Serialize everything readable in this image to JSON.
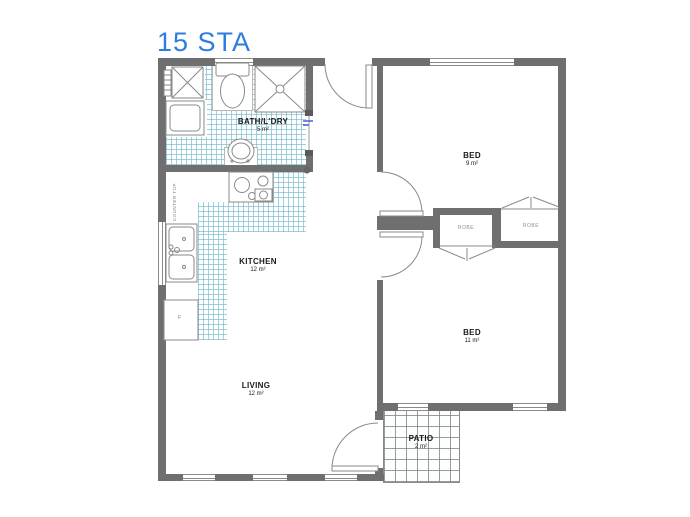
{
  "title": "15 STA",
  "rooms": [
    {
      "name": "BATH/L'DRY",
      "area": "5 m²"
    },
    {
      "name": "KITCHEN",
      "area": "12 m²"
    },
    {
      "name": "LIVING",
      "area": "12 m²"
    },
    {
      "name": "BED",
      "area": "9 m²"
    },
    {
      "name": "BED",
      "area": "11 m²"
    },
    {
      "name": "PATIO",
      "area": "2 m²"
    }
  ],
  "closets": [
    {
      "name": "ROBE"
    },
    {
      "name": "ROBE"
    }
  ],
  "annotations": {
    "counter_top": "COUNTER TOP",
    "fridge": "F"
  },
  "colors": {
    "title": "#2b7de0",
    "wall": "#6f6f6f",
    "tile_blue": "#76b6cb",
    "tile_gray": "#828282",
    "fixture_line": "#8a8a8a",
    "slider_accent": "#4a5fd0"
  }
}
